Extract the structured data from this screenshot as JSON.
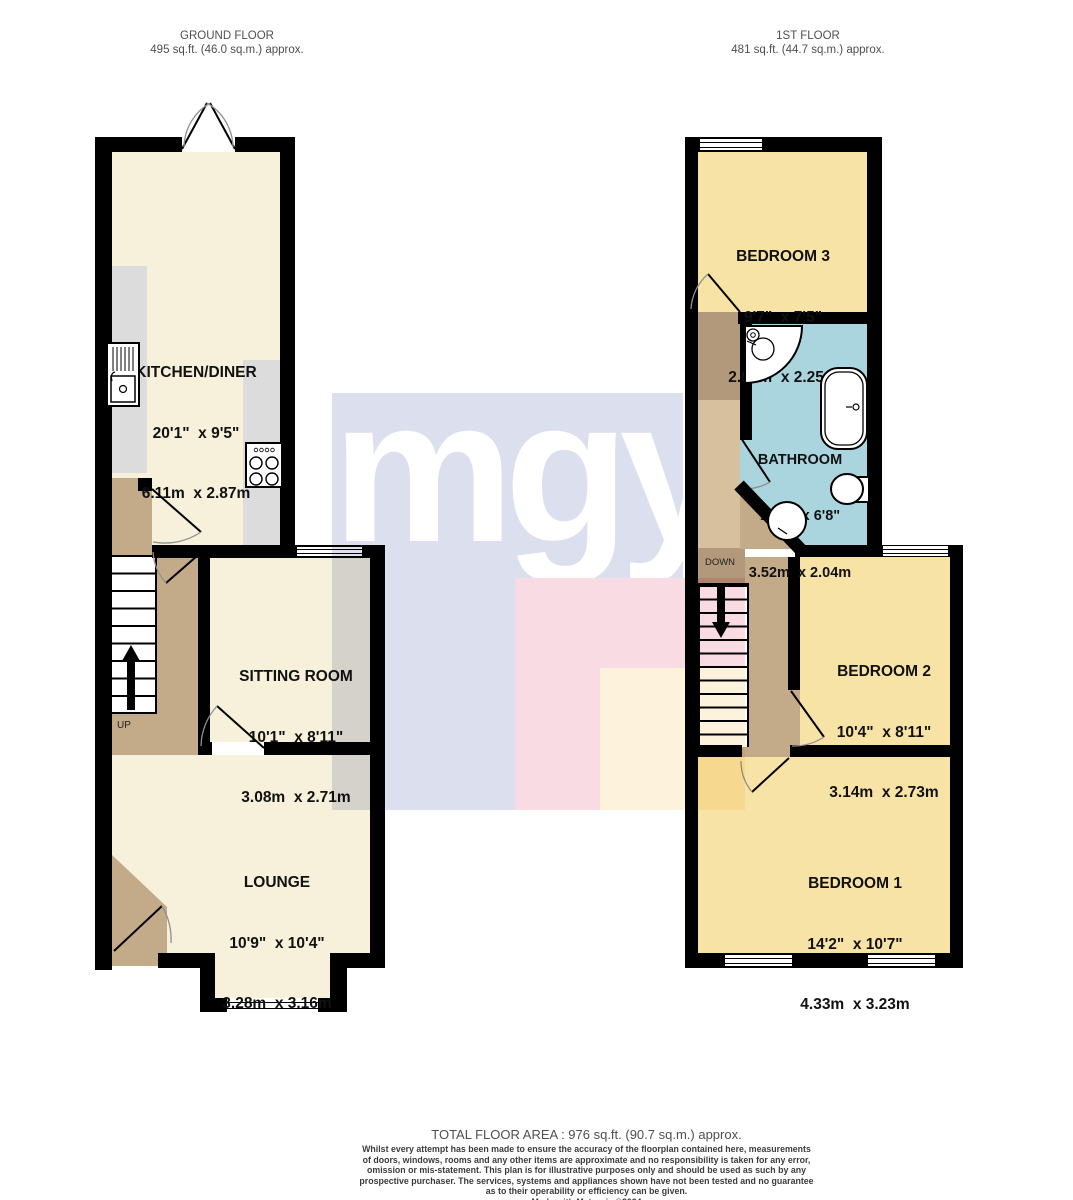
{
  "headers": {
    "ground_floor": {
      "title": "GROUND FLOOR",
      "area": "495 sq.ft. (46.0 sq.m.) approx."
    },
    "first_floor": {
      "title": "1ST FLOOR",
      "area": "481 sq.ft. (44.7 sq.m.) approx."
    }
  },
  "rooms": {
    "kitchen_diner": {
      "name": "KITCHEN/DINER",
      "size_imperial": "20'1\"  x 9'5\"",
      "size_metric": "6.11m  x 2.87m"
    },
    "sitting_room": {
      "name": "SITTING ROOM",
      "size_imperial": "10'1\"  x 8'11\"",
      "size_metric": "3.08m  x 2.71m"
    },
    "lounge": {
      "name": "LOUNGE",
      "size_imperial": "10'9\"  x 10'4\"",
      "size_metric": "3.28m  x 3.16m"
    },
    "bedroom_3": {
      "name": "BEDROOM 3",
      "size_imperial": "9'7\"  x 7'5\"",
      "size_metric": "2.93m  x 2.25m"
    },
    "bathroom": {
      "name": "BATHROOM",
      "size_imperial": "11'7\"  x 6'8\"",
      "size_metric": "3.52m  x 2.04m"
    },
    "bedroom_2": {
      "name": "BEDROOM 2",
      "size_imperial": "10'4\"  x 8'11\"",
      "size_metric": "3.14m  x 2.73m"
    },
    "bedroom_1": {
      "name": "BEDROOM 1",
      "size_imperial": "14'2\"  x 10'7\"",
      "size_metric": "4.33m  x 3.23m"
    }
  },
  "stairs": {
    "up_label": "UP",
    "down_label": "DOWN"
  },
  "watermark": {
    "text": "mgy"
  },
  "footer": {
    "total_area": "TOTAL FLOOR AREA : 976 sq.ft. (90.7 sq.m.) approx.",
    "disclaimer_lines": [
      "Whilst every attempt has been made to ensure the accuracy of the floorplan contained here, measurements",
      "of doors, windows, rooms and any other items are approximate and no responsibility is taken for any error,",
      "omission or mis-statement. This plan is for illustrative purposes only and should be used as such by any",
      "prospective purchaser. The services, systems and appliances shown have not been tested and no guarantee",
      "as to their operability or efficiency can be given.",
      "Made with Metropix ©2024"
    ]
  },
  "colors": {
    "wall": "#000000",
    "room_cream": "#f7f0da",
    "room_yellow": "#f8e3a6",
    "room_blue": "#abd5de",
    "hall_tan": "#c3aa88",
    "hall_tan_dark": "#b3997b",
    "hall_tan_light": "#d6c09e",
    "counter_gray": "#dcdcdc",
    "watermark_lavender": "#dbdfee",
    "watermark_pink": "#f9dce3",
    "watermark_cream": "#fdf3dc",
    "header_text": "#4f4f4f",
    "footer_text": "#3c3c3c"
  }
}
